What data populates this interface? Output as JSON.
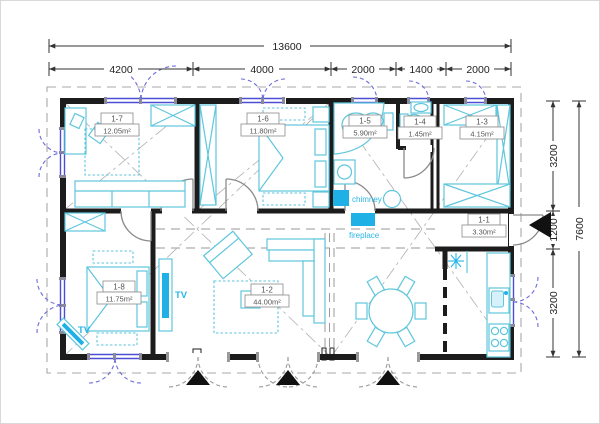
{
  "floorplan": {
    "dimensions": {
      "top_total": "13600",
      "top_segments": [
        "4200",
        "4000",
        "2000",
        "1400",
        "2000"
      ],
      "right_segments": [
        "3200",
        "1200",
        "3200"
      ],
      "right_total": "7600"
    },
    "rooms": [
      {
        "id": "1-7",
        "area": "12.05m²"
      },
      {
        "id": "1-6",
        "area": "11.80m²"
      },
      {
        "id": "1-5",
        "area": "5.90m²"
      },
      {
        "id": "1-4",
        "area": "1.45m²"
      },
      {
        "id": "1-3",
        "area": "4.15m²"
      },
      {
        "id": "1-1",
        "area": "3.30m²"
      },
      {
        "id": "1-8",
        "area": "11.75m²"
      },
      {
        "id": "1-2",
        "area": "44.00m²"
      }
    ],
    "annotations": {
      "chimney": "chimney",
      "fireplace": "fireplace",
      "tv_wall": "TV",
      "tv_corner": "TV"
    },
    "colors": {
      "wall": "#1c1c1c",
      "furniture": "#5fc6dd",
      "accent": "#1fb0e6",
      "window": "#4d4dd4"
    }
  }
}
